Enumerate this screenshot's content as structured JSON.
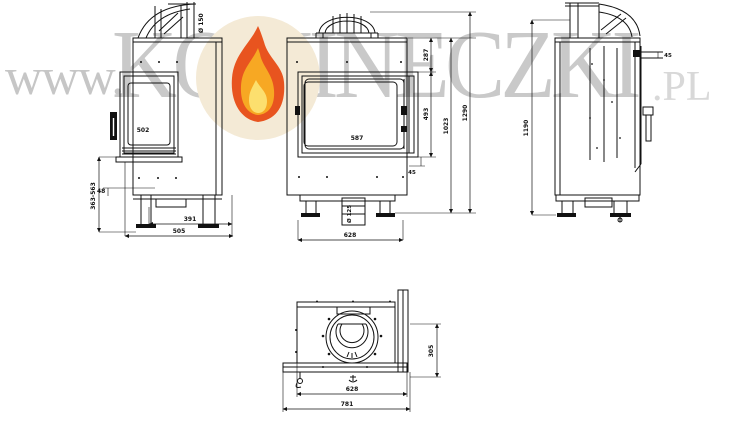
{
  "page": {
    "background": "#ffffff"
  },
  "watermark": {
    "prefix": "www.",
    "brand": "KOMINECZKI",
    "tld": ".PL",
    "text_color": "#c9c9c9",
    "tld_color": "#d8d8d8",
    "logo_icon": "flame-icon",
    "logo_circle_color": "#f4ead6",
    "flame_colors": [
      "#e8541f",
      "#f7a823",
      "#fcdf6e"
    ]
  },
  "drawing": {
    "line_color": "#111111",
    "views": {
      "side_view": {
        "flue_diameter_label": "Ø 150",
        "glass_label": "502",
        "leg_height_range": "363-563",
        "base_lip_height": "48",
        "base_depth_inner": "391",
        "base_depth_outer": "505"
      },
      "front_view": {
        "top_section_height": "287",
        "glass_height": "493",
        "body_height": "1023",
        "total_height": "1290",
        "glass_width": "587",
        "door_gap": "45",
        "air_inlet_label": "Ø 125",
        "body_width": "628"
      },
      "right_side_view": {
        "total_height": "1190",
        "ledge_offset": "45"
      },
      "plan_view": {
        "inner_width": "628",
        "overall_width": "781",
        "side_glass_depth": "305"
      }
    }
  }
}
